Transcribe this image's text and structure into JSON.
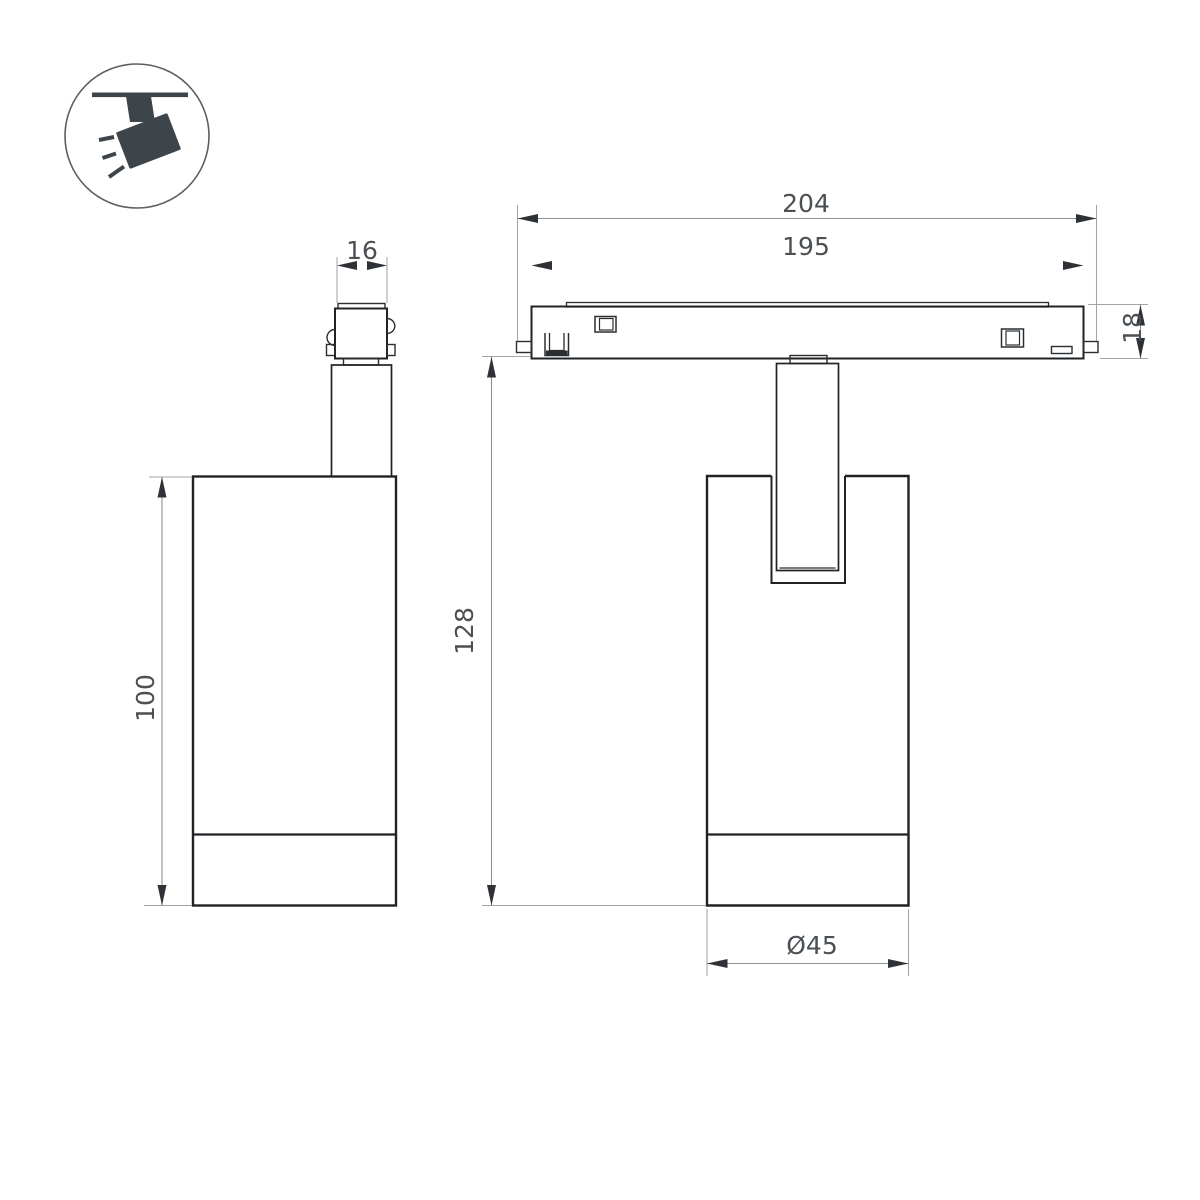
{
  "page": {
    "background": "#ffffff"
  },
  "icon": {
    "name": "track-spotlight-icon",
    "fill": "#3d444a",
    "ring_color": "#5a5f64"
  },
  "views": {
    "front_view": "front projection of track spotlight",
    "side_view": "side projection of track spotlight on magnetic track"
  },
  "dims": {
    "adapter_width": {
      "label": "16"
    },
    "body_height": {
      "label": "100"
    },
    "track_overall_length": {
      "label": "204"
    },
    "track_inner_length": {
      "label": "195"
    },
    "track_height": {
      "label": "18"
    },
    "fixture_height": {
      "label": "128"
    },
    "body_diameter": {
      "label": "Ø45"
    }
  },
  "colors": {
    "outline": "#1f2326",
    "detail": "#2a2e31",
    "dimension_line": "#8f9092",
    "extension_line": "#a3a4a6",
    "arrowhead": "#2e3236",
    "text": "#4b5054",
    "icon_fill": "#3d444a"
  }
}
